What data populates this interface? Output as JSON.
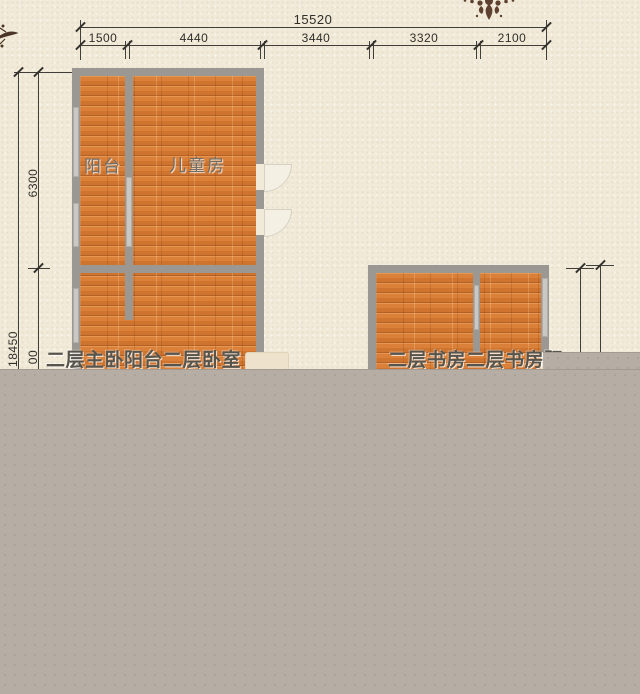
{
  "dimensions": {
    "top_total": "15520",
    "top_segments": [
      "1500",
      "4440",
      "3440",
      "3320",
      "2100"
    ],
    "left_total": "18450",
    "left_upper": "6300",
    "left_partial": "00"
  },
  "rooms": {
    "balcony": "阳台",
    "kids_room": "儿童房",
    "left_caption": "二层主卧阳台二层卧室",
    "right_caption": "二层书房二层书房阳"
  },
  "icons": {
    "damask_ornament": "damask-ornament",
    "branch_ornament": "branch-ornament"
  },
  "colors": {
    "background": "#f1ead8",
    "covered_area": "#b6ada4",
    "wall": "#9b9792",
    "window": "#c9c8c4",
    "floor": "#db8038",
    "dim_line": "#3f3e39",
    "caption_text": "#57544b",
    "ornament": "#5e4130"
  }
}
